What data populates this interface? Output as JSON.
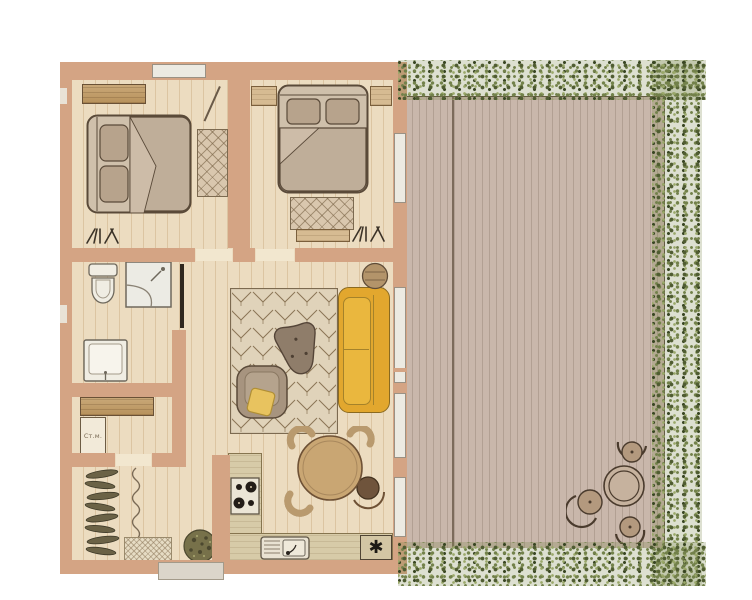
{
  "plan": {
    "kind": "apartment-floor-plan-with-terrace",
    "labels": {
      "washing_machine": "Ст.м.",
      "appliance_symbol": "✱"
    },
    "rooms": [
      "bedroom-1",
      "bedroom-2",
      "bathroom",
      "utility-room",
      "entry-hall",
      "hallway",
      "living-room",
      "kitchen",
      "terrace-deck"
    ],
    "furniture": [
      "double-bed-1",
      "wardrobe",
      "bedroom-rug-1",
      "coat-hooks",
      "double-bed-2",
      "nightstand-left",
      "nightstand-right",
      "bedroom-rug-2",
      "bench",
      "toilet",
      "corner-shower",
      "washbasin",
      "washing-machine",
      "utility-cabinet",
      "entry-coat-rack",
      "doormat",
      "potted-plant",
      "living-rug",
      "sofa",
      "side-table",
      "coffee-table",
      "armchair",
      "throw-pillow",
      "dining-table-with-chairs",
      "kitchen-counter",
      "stove",
      "kitchen-sink",
      "appliance-tile",
      "deck-table-with-stools"
    ]
  },
  "colors": {
    "background": "#ffffff",
    "wall": "#d4a484",
    "floor": "#ecdcc0",
    "floor_line": "#dcc5a2",
    "deck": "#c9b7ab",
    "deck_line": "#b2a093",
    "greenery_dark": "#4f5c31",
    "greenery_mid": "#72814a",
    "greenery_light": "#9aa86a",
    "sofa": "#e2a72e",
    "rug": "#ded0b6",
    "rug_line": "#8a7457",
    "wood": "#c49e6f",
    "outline": "#5f4f3e",
    "fixture": "#f0ede3"
  }
}
